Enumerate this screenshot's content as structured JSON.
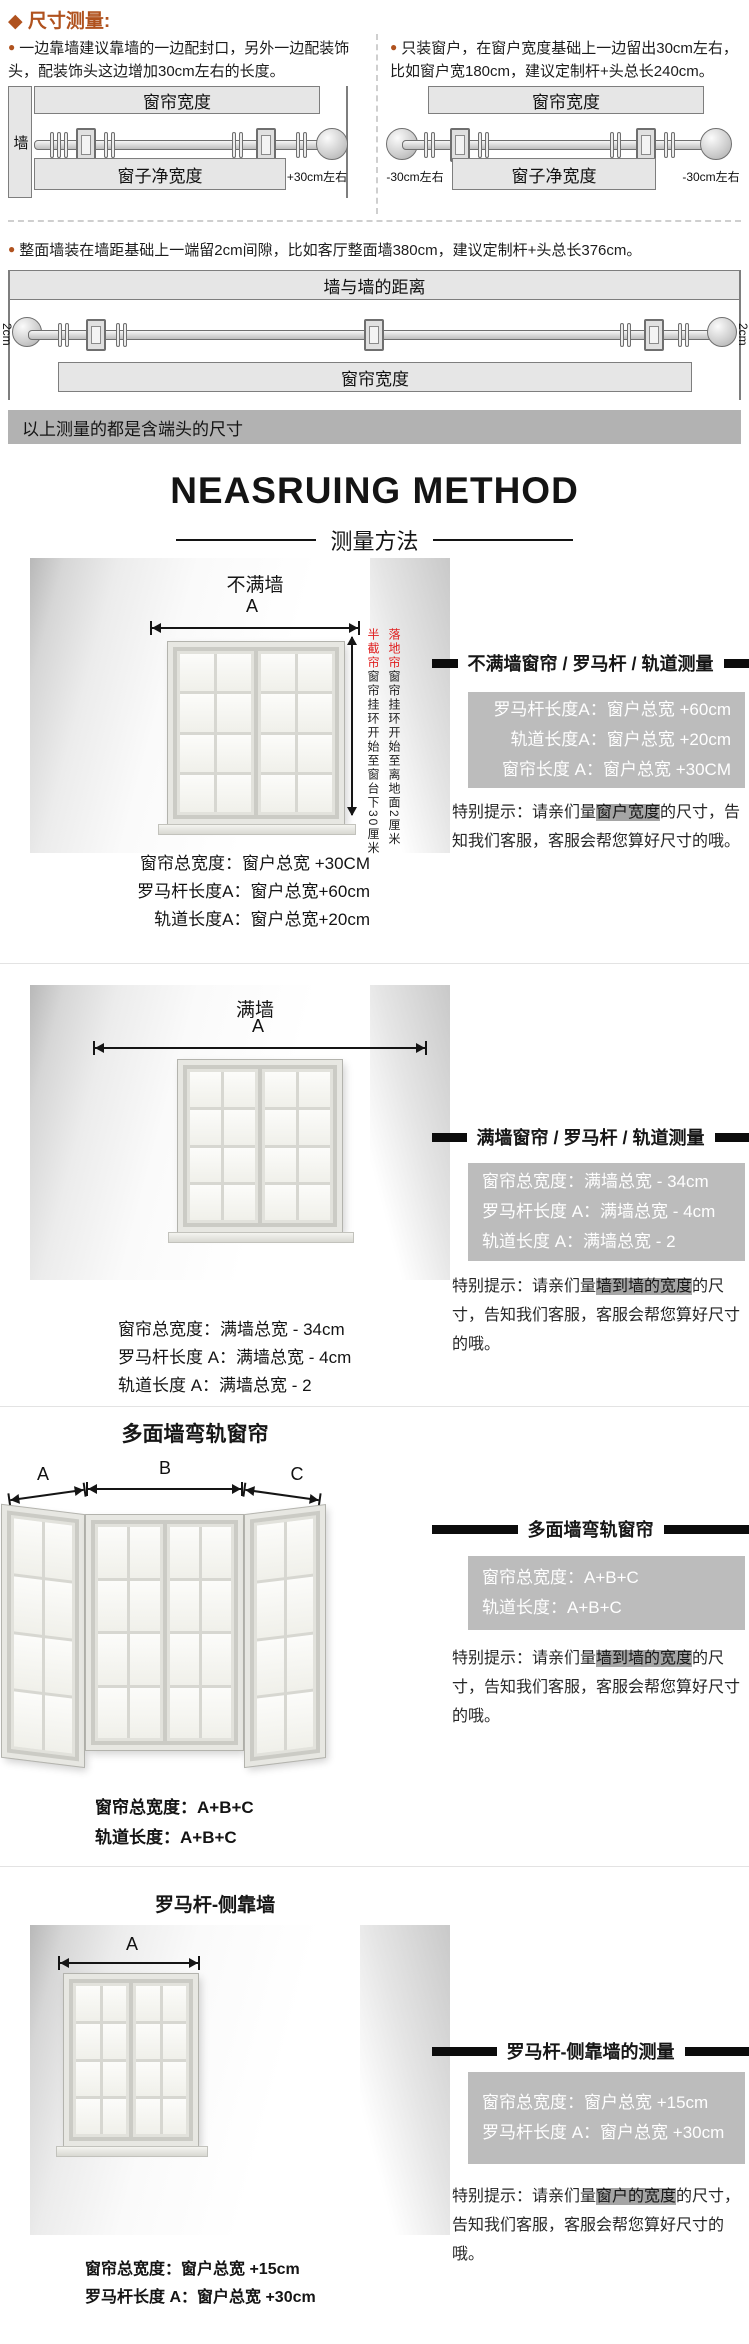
{
  "top": {
    "diamond_icon": "◆",
    "heading": "尺寸测量:",
    "bullet_icon": "●",
    "tip_left": "一边靠墙建议靠墙的一边配封口，另外一边配装饰头，配装饰头这边增加30cm左右的长度。",
    "tip_right": "只装窗户，在窗户宽度基础上一边留出30cm左右，比如窗户宽180cm，建议定制杆+头总长240cm。",
    "dia_left": {
      "wall": "墙",
      "curtain": "窗帘宽度",
      "window": "窗子净宽度",
      "note": "+30cm左右"
    },
    "dia_right": {
      "curtain": "窗帘宽度",
      "window": "窗子净宽度",
      "note_l": "-30cm左右",
      "note_r": "-30cm左右"
    },
    "tip_fullwall": "整面墙装在墙距基础上一端留2cm间隙，比如客厅整面墙380cm，建议定制杆+头总长376cm。",
    "dia_wide": {
      "wall2wall": "墙与墙的距离",
      "gap_l": "2cm",
      "gap_r": "2cm",
      "curtain": "窗帘宽度"
    },
    "notice": "以上测量的都是含端头的尺寸"
  },
  "title": {
    "en": "NEASRUING METHOD",
    "zh": "测量方法"
  },
  "sections": [
    {
      "title": "不满墙",
      "dim": "A",
      "vnotes": [
        {
          "red": "落地帘",
          "text": "窗帘挂环开始至离地面2厘米"
        },
        {
          "red": "半截帘",
          "text": "窗帘挂环开始至窗台下30厘米"
        }
      ],
      "formulas": [
        "窗帘总宽度：窗户总宽 +30CM",
        "罗马杆长度A：窗户总宽+60cm",
        "轨道长度A：窗户总宽+20cm"
      ],
      "panel": {
        "header": "不满墙窗帘 / 罗马杆 / 轨道测量",
        "lines": [
          "罗马杆长度A：窗户总宽 +60cm",
          "轨道长度A：窗户总宽 +20cm",
          "窗帘长度 A：窗户总宽 +30CM"
        ],
        "tip_pre": "特别提示：请亲们量",
        "tip_hl": "窗户宽度",
        "tip_post": "的尺寸，告知我们客服，客服会帮您算好尺寸的哦。"
      }
    },
    {
      "title": "满墙",
      "dim": "A",
      "formulas": [
        "窗帘总宽度：满墙总宽 - 34cm",
        "罗马杆长度 A：满墙总宽 - 4cm",
        "轨道长度 A：满墙总宽 - 2"
      ],
      "panel": {
        "header": "满墙窗帘 / 罗马杆 / 轨道测量",
        "lines": [
          "窗帘总宽度：满墙总宽 - 34cm",
          "罗马杆长度 A：满墙总宽 - 4cm",
          "轨道长度 A：满墙总宽 - 2"
        ],
        "tip_pre": "特别提示：请亲们量",
        "tip_hl": "墙到墙的宽度",
        "tip_post": "的尺寸，告知我们客服，客服会帮您算好尺寸的哦。"
      }
    },
    {
      "title": "多面墙弯轨窗帘",
      "dims": [
        "A",
        "B",
        "C"
      ],
      "formulas": [
        "窗帘总宽度：A+B+C",
        "轨道长度：A+B+C"
      ],
      "panel": {
        "header": "多面墙弯轨窗帘",
        "lines": [
          "窗帘总宽度：A+B+C",
          "轨道长度：A+B+C"
        ],
        "tip_pre": "特别提示：请亲们量",
        "tip_hl": "墙到墙的宽度",
        "tip_post": "的尺寸，告知我们客服，客服会帮您算好尺寸的哦。"
      }
    },
    {
      "title": "罗马杆-侧靠墙",
      "dim": "A",
      "formulas": [
        "窗帘总宽度：窗户总宽 +15cm",
        "罗马杆长度 A：窗户总宽 +30cm"
      ],
      "panel": {
        "header": "罗马杆-侧靠墙的测量",
        "lines": [
          "窗帘总宽度：窗户总宽 +15cm",
          "罗马杆长度 A：窗户总宽 +30cm"
        ],
        "tip_pre": "特别提示：请亲们量",
        "tip_hl": "窗户的宽度",
        "tip_post": "的尺寸，告知我们客服，客服会帮您算好尺寸的哦。"
      }
    }
  ]
}
